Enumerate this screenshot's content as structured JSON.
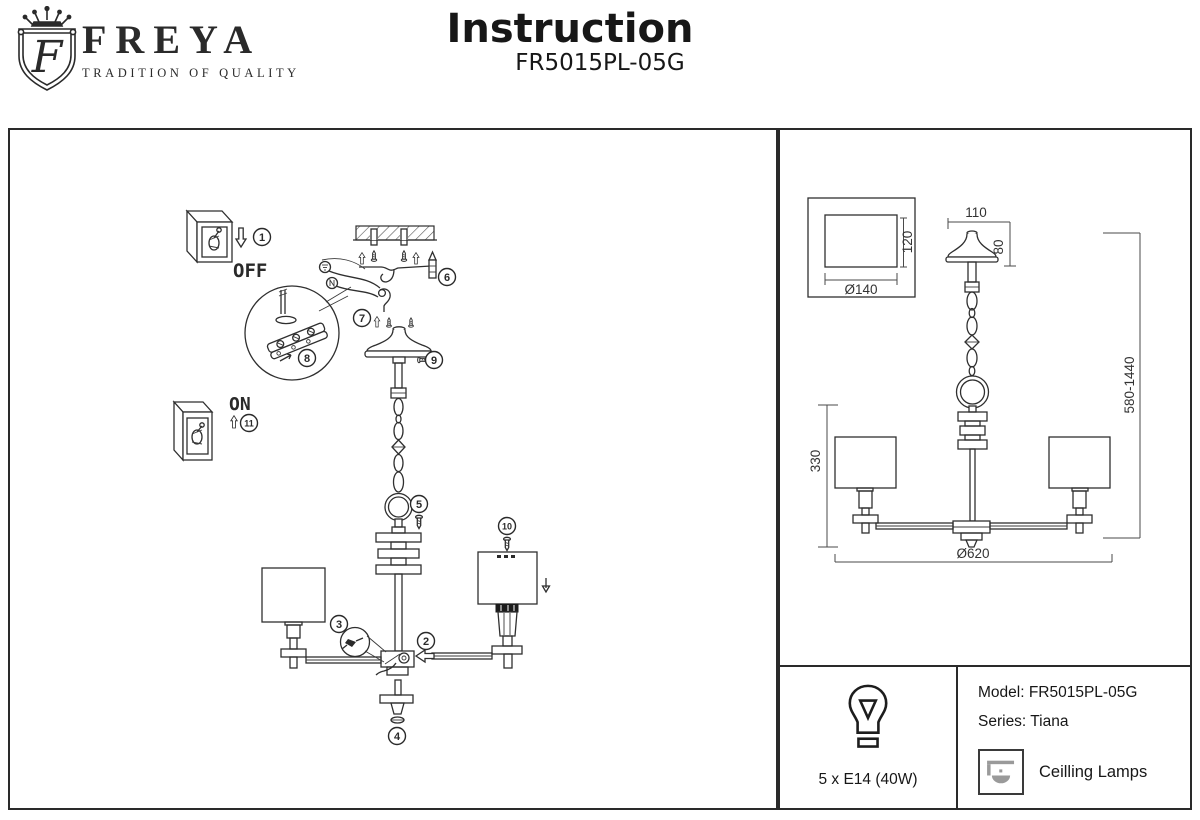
{
  "header": {
    "brand": "FREYA",
    "tagline": "TRADITION OF QUALITY",
    "title": "Instruction",
    "model": "FR5015PL-05G"
  },
  "colors": {
    "line": "#2f2f2f",
    "icon_gray": "#9a9a9a"
  },
  "icons": {
    "logo": "freya-crest-shield",
    "bulb": "light-bulb-outline",
    "category": "ceiling-lamp"
  },
  "assembly": {
    "off_label": "OFF",
    "on_label": "ON",
    "steps": {
      "n1": "1",
      "n2": "2",
      "n3": "3",
      "n4": "4",
      "n5": "5",
      "n6": "6",
      "n7": "7",
      "n8": "8",
      "n9": "9",
      "n10": "10",
      "n11": "11"
    }
  },
  "dimensions": {
    "canopy_plate_diameter": "Ø140",
    "canopy_plate_height": "120",
    "cup_width": "110",
    "cup_height": "80",
    "overall_height": "580-1440",
    "lamp_height": "330",
    "diameter": "Ø620"
  },
  "specs": {
    "bulbs": "5 x E14 (40W)",
    "model_label": "Model: FR5015PL-05G",
    "series_label": "Series: Tiana",
    "category_label": "Ceilling Lamps"
  }
}
